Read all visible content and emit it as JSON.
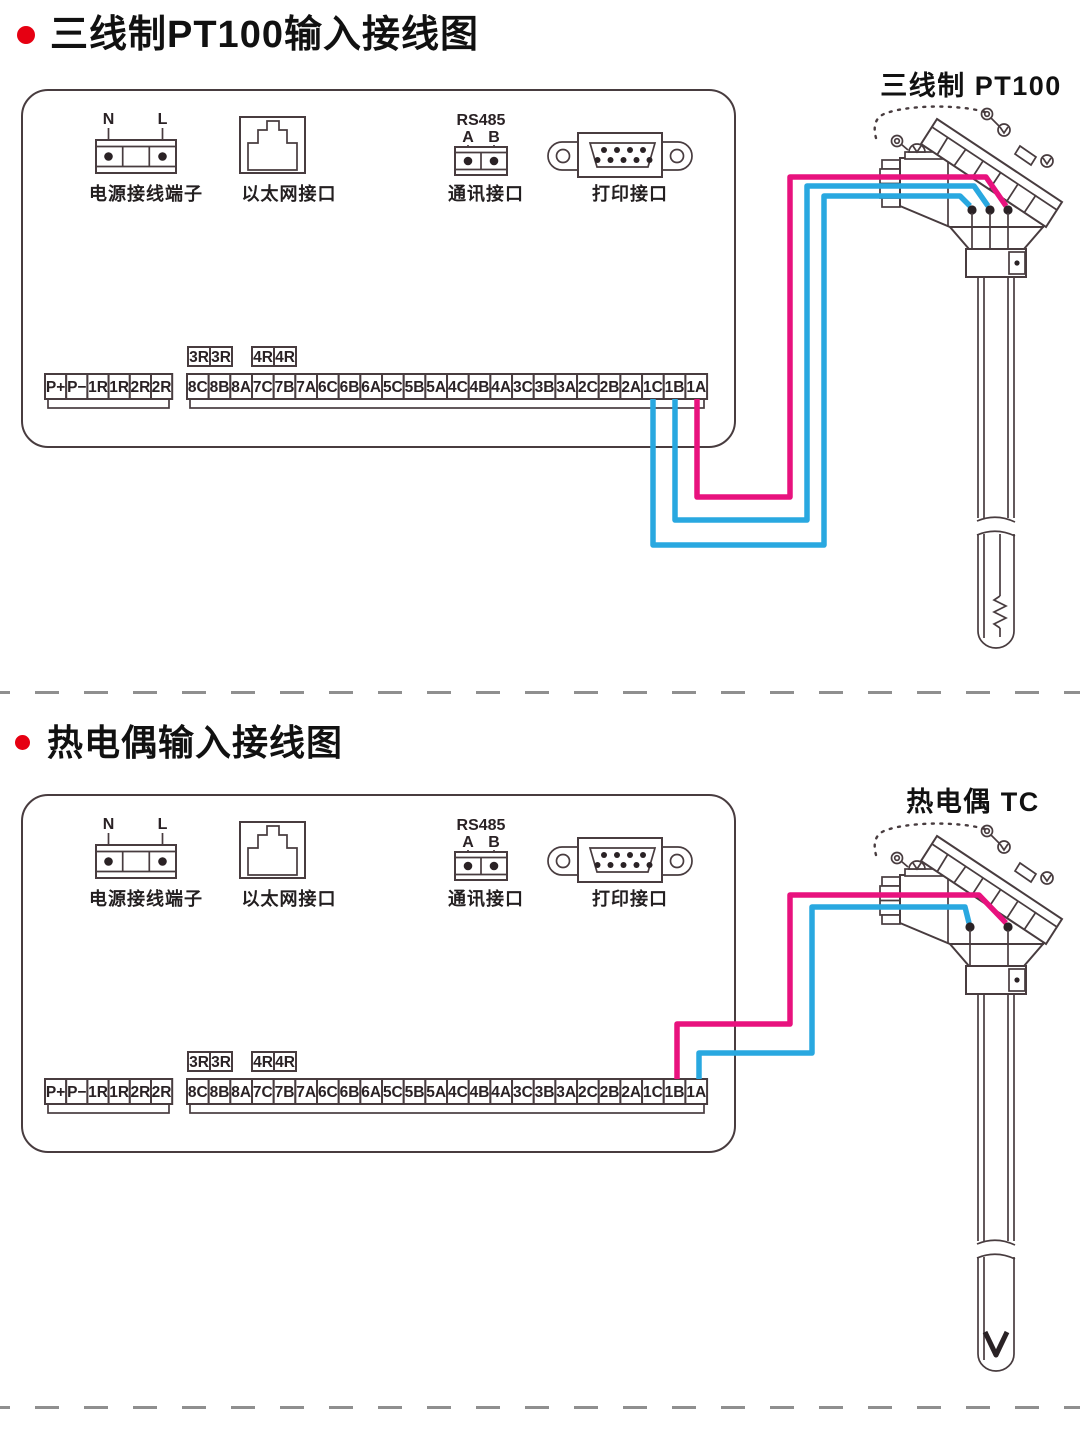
{
  "sections": [
    {
      "title": "三线制PT100输入接线图",
      "sensor_label": "三线制 PT100",
      "sensor_type": "pt100-3wire",
      "connections": [
        {
          "wire": "magenta",
          "from_terminal": "1A",
          "to": "sensor right pin"
        },
        {
          "wire": "blue",
          "from_terminal": "1B",
          "to": "sensor middle pin"
        },
        {
          "wire": "blue",
          "from_terminal": "1C",
          "to": "sensor left pin"
        }
      ]
    },
    {
      "title": "热电偶输入接线图",
      "sensor_label": "热电偶 TC",
      "sensor_type": "thermocouple",
      "connections": [
        {
          "wire": "magenta",
          "from_terminal": "1B",
          "to": "sensor right pin"
        },
        {
          "wire": "blue",
          "from_terminal": "1A",
          "to": "sensor left pin"
        }
      ]
    }
  ],
  "panel": {
    "power": {
      "label": "电源接线端子",
      "pin_n": "N",
      "pin_l": "L"
    },
    "ethernet": {
      "label": "以太网接口"
    },
    "comm": {
      "label": "通讯接口",
      "header": "RS485",
      "pin_a": "A",
      "pin_b": "B"
    },
    "printer": {
      "label": "打印接口"
    },
    "terminals": {
      "group1": [
        "P+",
        "P−",
        "1R",
        "1R",
        "2R",
        "2R"
      ],
      "group2": [
        "8C",
        "8B",
        "8A",
        "7C",
        "7B",
        "7A",
        "6C",
        "6B",
        "6A",
        "5C",
        "5B",
        "5A",
        "4C",
        "4B",
        "4A",
        "3C",
        "3B",
        "3A",
        "2C",
        "2B",
        "2A",
        "1C",
        "1B",
        "1A"
      ],
      "aux": [
        "3R",
        "3R",
        "4R",
        "4R"
      ]
    }
  },
  "colors": {
    "accent_red": "#e60012",
    "wire_magenta": "#e8127e",
    "wire_blue": "#29a8e0",
    "line_art": "#483c3f",
    "divider_gray": "#8f8f8f"
  }
}
